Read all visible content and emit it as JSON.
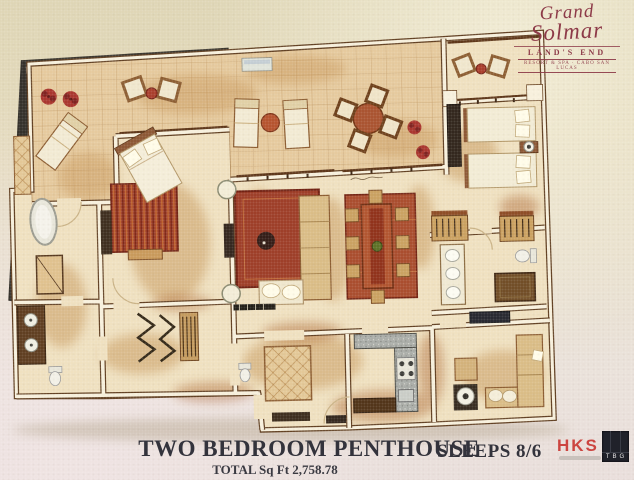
{
  "logo": {
    "brand_line1": "Grand",
    "brand_line2": "Solmar",
    "sub_line": "LAND'S END",
    "tagline": "RESORT & SPA · CABO SAN LUCAS"
  },
  "caption": {
    "title": "TWO BEDROOM PENTHOUSE",
    "total_sqft": "TOTAL Sq Ft 2,758.78",
    "sleeps": "SLEEPS 8/6"
  },
  "firms": {
    "architect": "HKS",
    "landscape": "TBG"
  },
  "colors": {
    "logo_maroon": "#8d3a48",
    "hks_red": "#cc4540",
    "rug_red": "#9c3a22",
    "dining_rug_red": "#a84a2a",
    "tile_tan": "#e5c99c",
    "wall_cream": "#f7f0dc",
    "floor_cream": "#efe0bf",
    "wood_brown": "#ad6b35",
    "dark_board_edge": "#2f2c26"
  },
  "plan_elements": [
    "left-terrace",
    "center-terrace",
    "balcony",
    "master-bedroom",
    "master-bath",
    "vanity-room",
    "hall-closets",
    "living-room",
    "dining-room",
    "kitchen",
    "foyer",
    "bedroom-2",
    "bath-2",
    "den"
  ]
}
